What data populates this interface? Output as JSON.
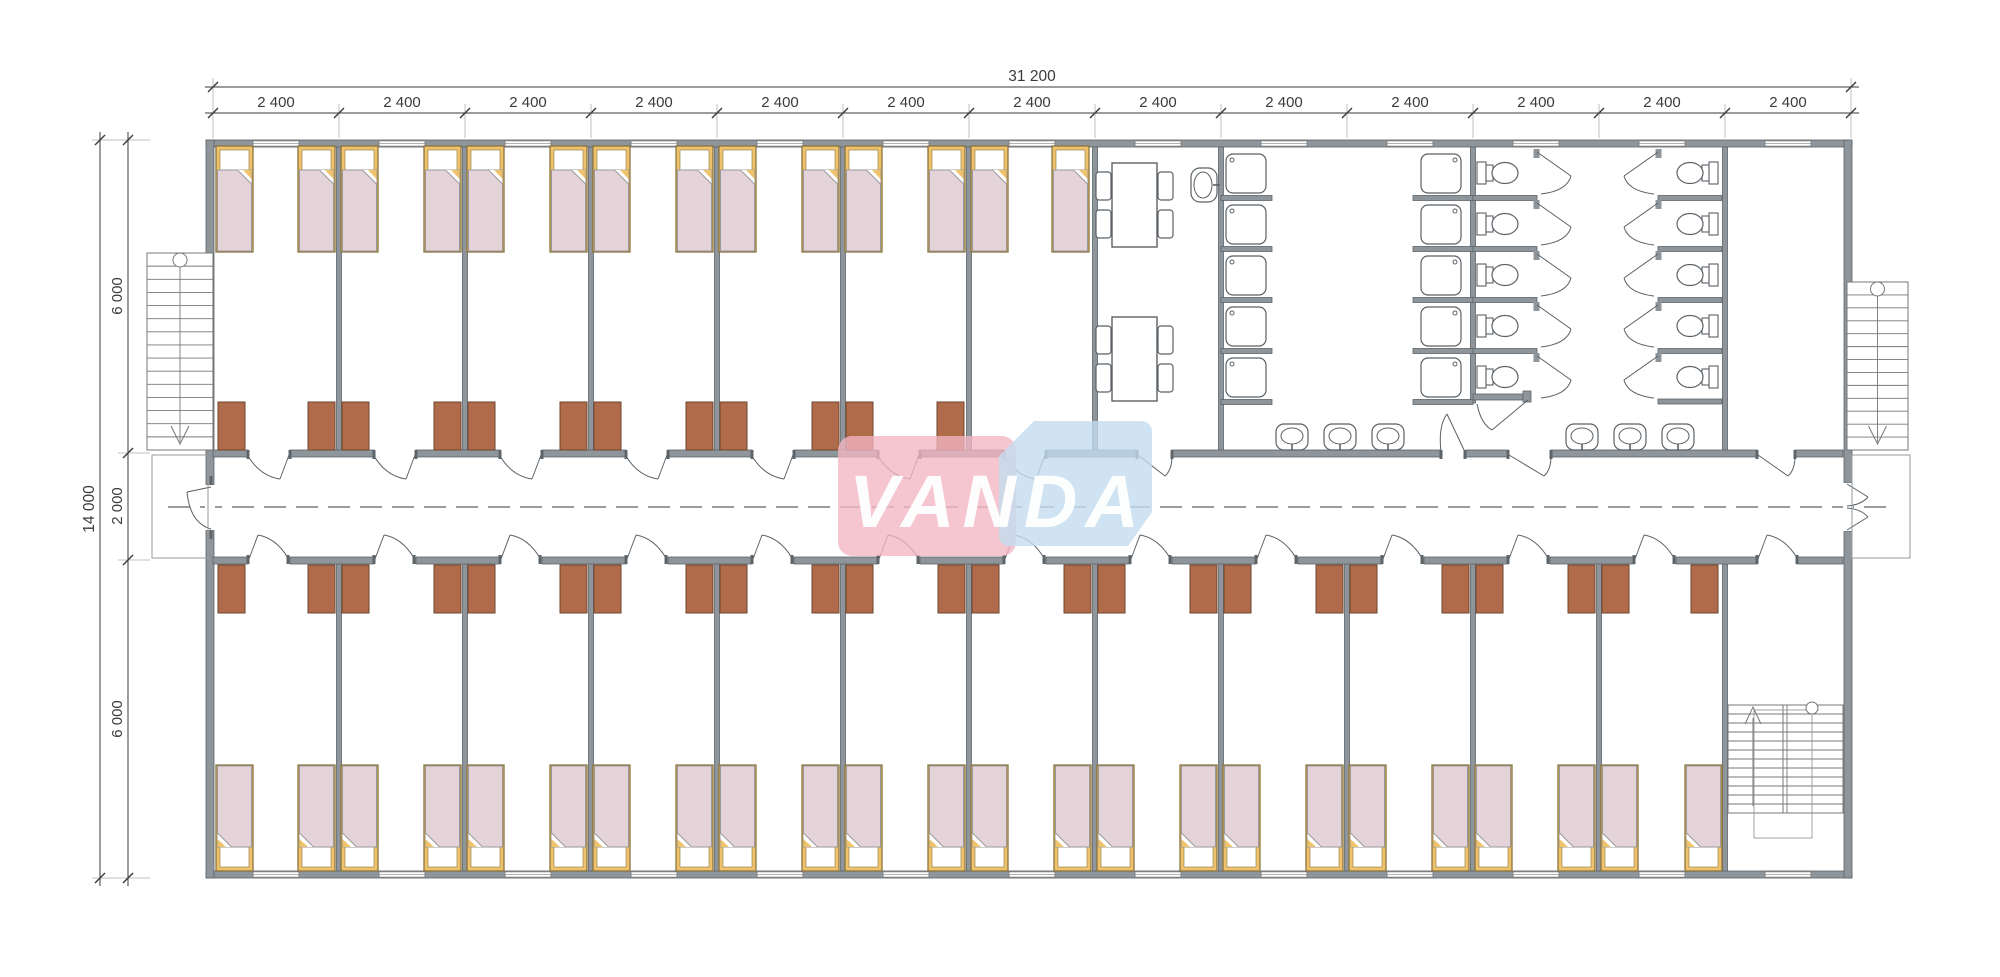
{
  "plan": {
    "title": "dormitory-floor-plan",
    "logo": {
      "text": "VANDA",
      "pink": "#F3B6C3",
      "blue": "#C3DCEF",
      "text_color": "#FFFFFF"
    },
    "dimensions": {
      "total_width": "31 200",
      "bay": "2 400",
      "bay_count": 13,
      "total_height": "14 000",
      "height_segments": [
        "6 000",
        "2 000",
        "6 000"
      ]
    },
    "colors": {
      "wall": "#8E969B",
      "wall_stroke": "#5D656A",
      "fixture_line": "#5A6065",
      "bed_frame": "#EFC36B",
      "bed_frame_stroke": "#8A7340",
      "mattress": "#E4D3D8",
      "mattress_stroke": "#9A9A9A",
      "pillow": "#FFFFFF",
      "wardrobe": "#AF6B4A",
      "wardrobe_stroke": "#6F462F",
      "dim_line": "#3A3A3A",
      "dash": "#5A6065",
      "background": "#FFFFFF"
    },
    "fixtures": {
      "beds_top_row": 14,
      "beds_bottom_row": 24,
      "wardrobes_top_row": 12,
      "wardrobes_bottom_row": 24,
      "dining_tables": 2,
      "chairs_per_table": 4,
      "shower_stalls": 10,
      "toilet_stalls": 10,
      "wall_mounted_sinks": 6,
      "dining_sinks": 1,
      "windows": 26,
      "staircases": [
        "exterior-left",
        "exterior-right",
        "interior-bottom-right"
      ]
    }
  }
}
